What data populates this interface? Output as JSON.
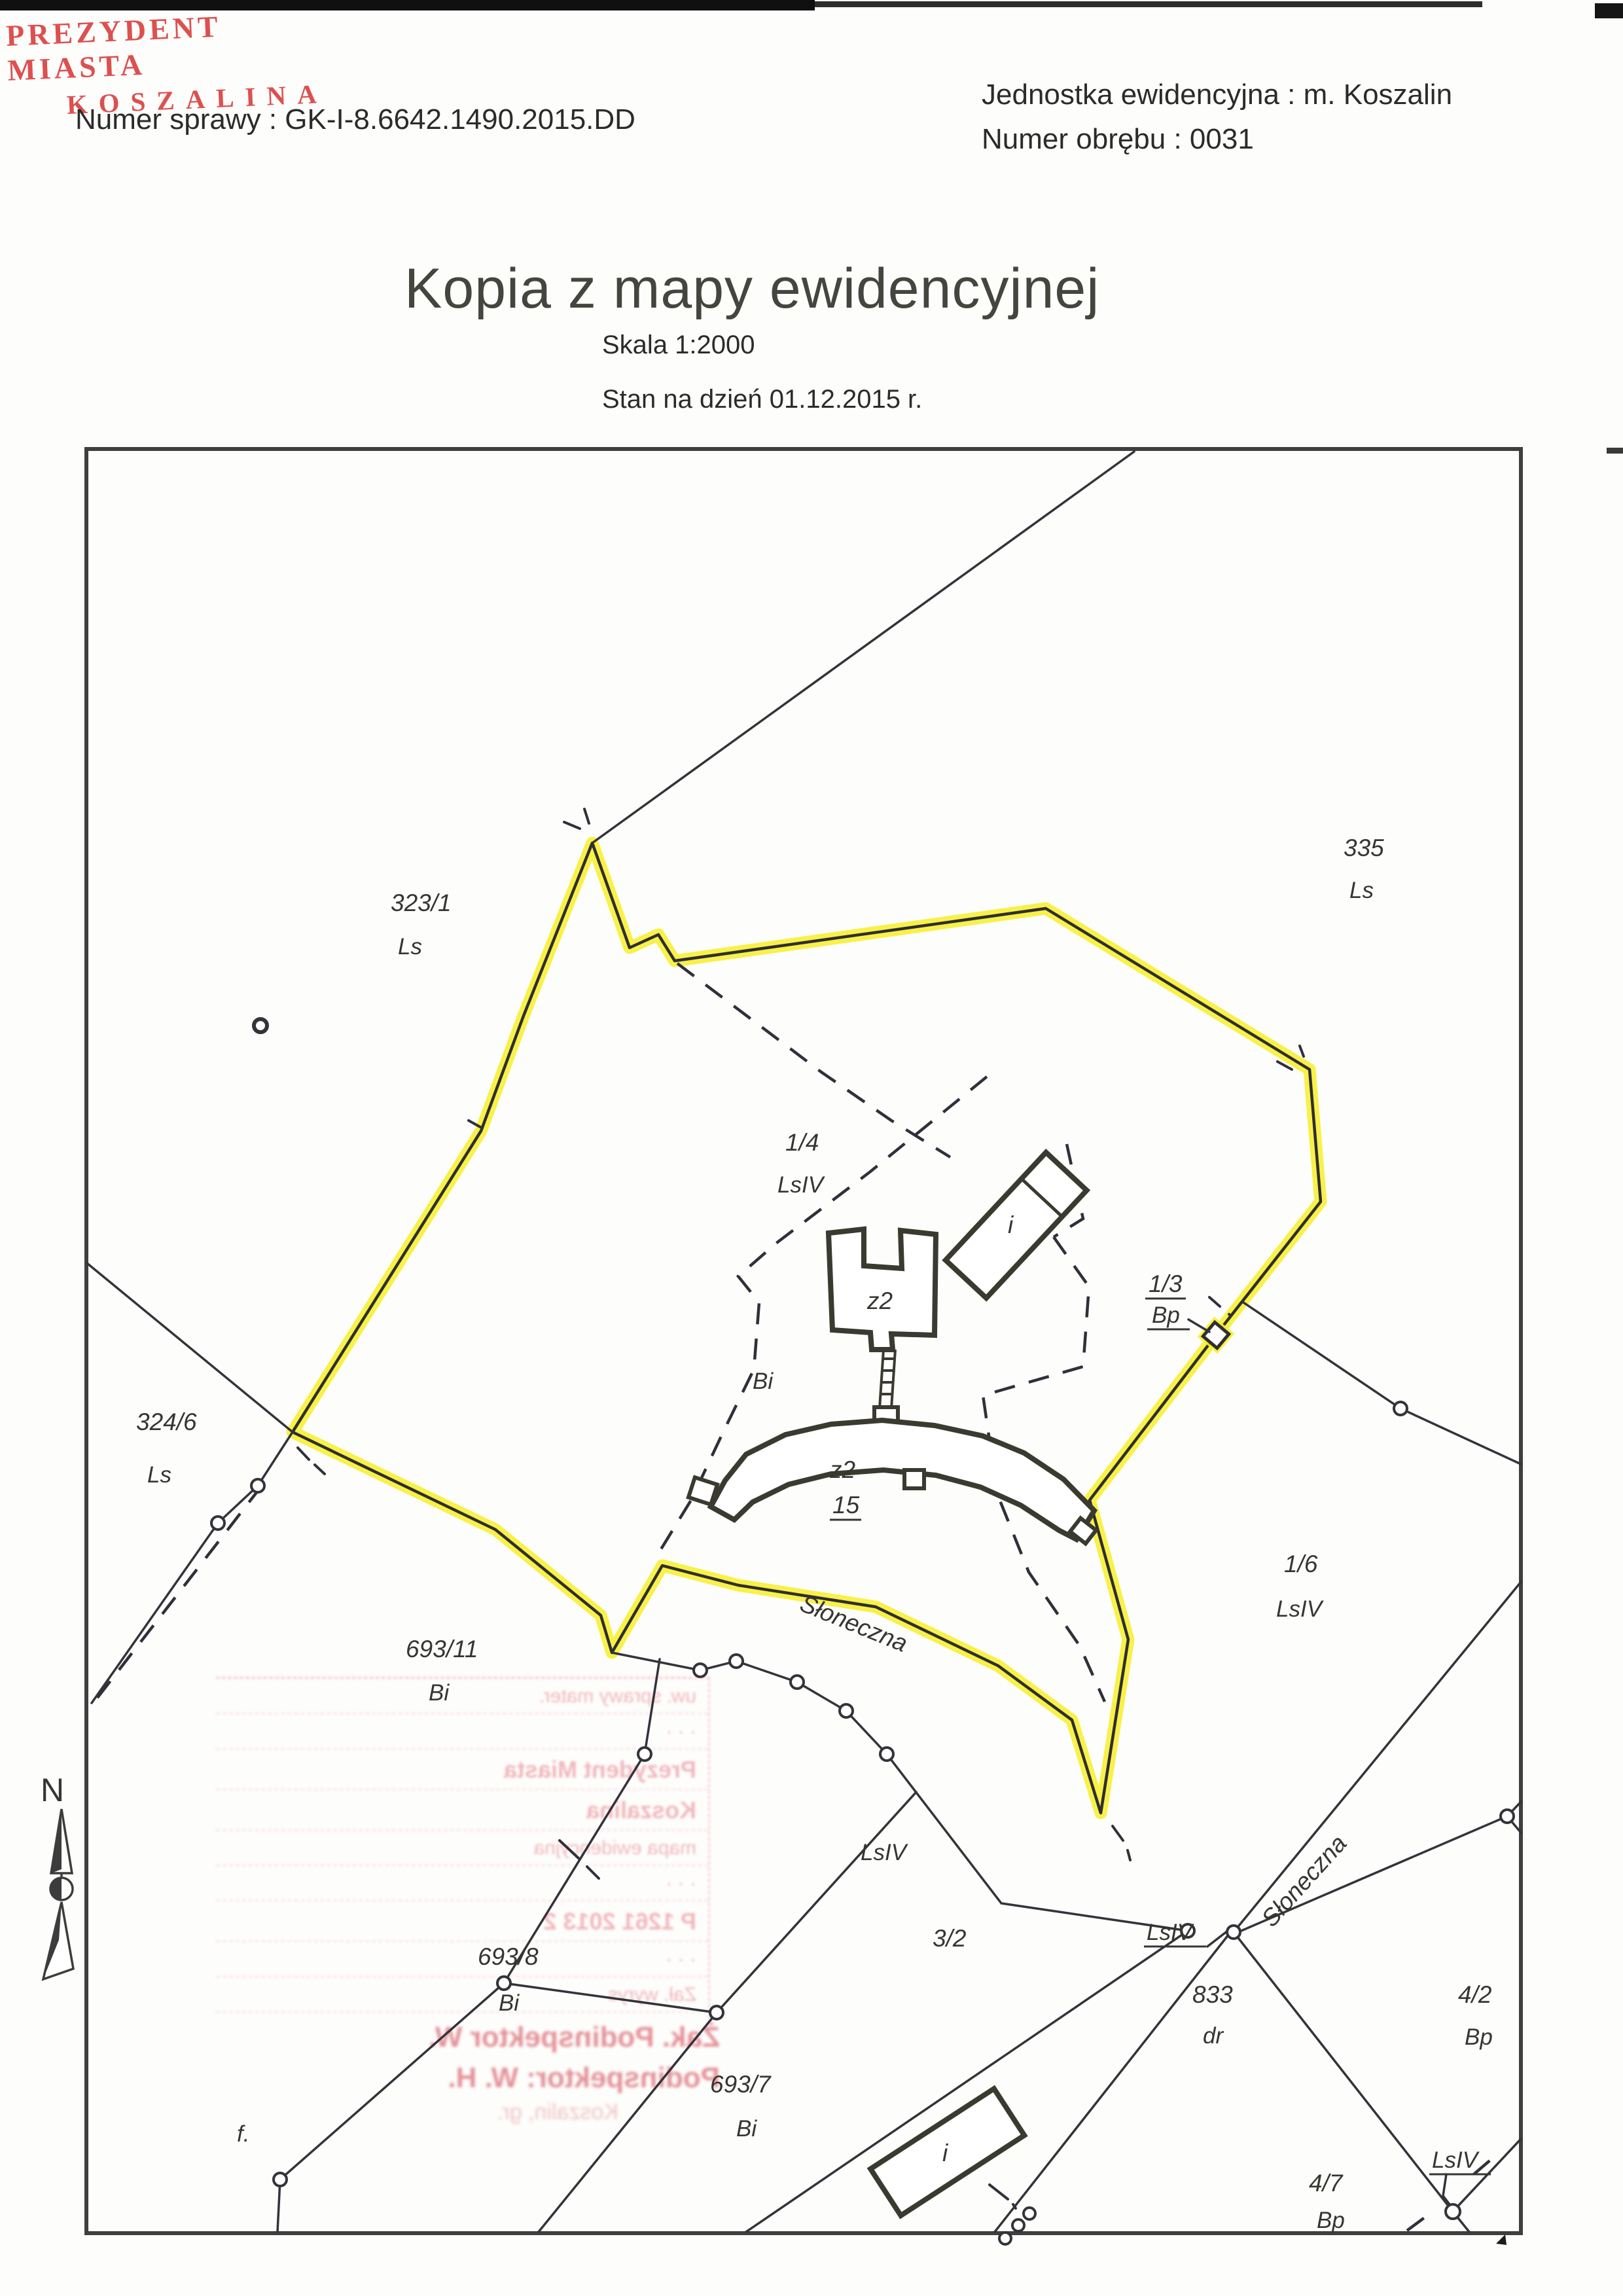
{
  "header": {
    "authority_line1": "PREZYDENT MIASTA",
    "authority_line2": "KOSZALINA",
    "case_number": "Numer sprawy : GK-I-8.6642.1490.2015.DD",
    "registration_unit": "Jednostka ewidencyjna : m. Koszalin",
    "precinct_number": "Numer obrębu : 0031"
  },
  "title": {
    "main": "Kopia z mapy ewidencyjnej",
    "scale": "Skala 1:2000",
    "state_date": "Stan na dzień 01.12.2015 r."
  },
  "map": {
    "north_label": "N",
    "parcels": [
      {
        "number": "323/1",
        "use": "Ls"
      },
      {
        "number": "335",
        "use": "Ls"
      },
      {
        "number": "324/6",
        "use": "Ls"
      },
      {
        "number": "1/4",
        "use": "LsIV"
      },
      {
        "number": "1/3",
        "use": "Bp"
      },
      {
        "number": "1/6",
        "use": "LsIV"
      },
      {
        "number": "693/11",
        "use": "Bi"
      },
      {
        "number": "693/8",
        "use": "Bi"
      },
      {
        "number": "693/7",
        "use": "Bi"
      },
      {
        "number": "3/2",
        "use": ""
      },
      {
        "number": "833",
        "use": "dr"
      },
      {
        "number": "4/2",
        "use": "Bp"
      },
      {
        "number": "4/7",
        "use": "Bp"
      }
    ],
    "overlay_labels": {
      "bi_mid": "Bi",
      "lsiv_mid": "LsIV",
      "lsiv_junction": "LsIV",
      "lsiv_corner": "LsIV",
      "f_mark": "f.",
      "z2_upper": "z2",
      "z2_lower": "z2",
      "house_no_15": "15",
      "i_upper": "i",
      "i_lower": "i",
      "street_upper": "Słoneczna",
      "street_lower": "Słoneczna"
    }
  },
  "stamp": {
    "rows": [
      "uw. sprawy mater.",
      "· · ·",
      "Prezydent Miasta",
      "Koszalina",
      "mapa ewidencyjna",
      "· · ·",
      "P 1261 2013 2",
      "· · ·",
      "Zał. wyrys"
    ],
    "below_line1": "Żak. Podinspektor W.",
    "below_line2": "Podinspektor: W. H.",
    "below_line3": "Koszalin, gr."
  },
  "colors": {
    "highlight_yellow": "#f7ef28",
    "map_line": "#33333a",
    "building_line": "#3a3a30",
    "header_red": "#dd5050",
    "stamp_pink": "#e87d8a",
    "paper": "#fdfdfb"
  }
}
